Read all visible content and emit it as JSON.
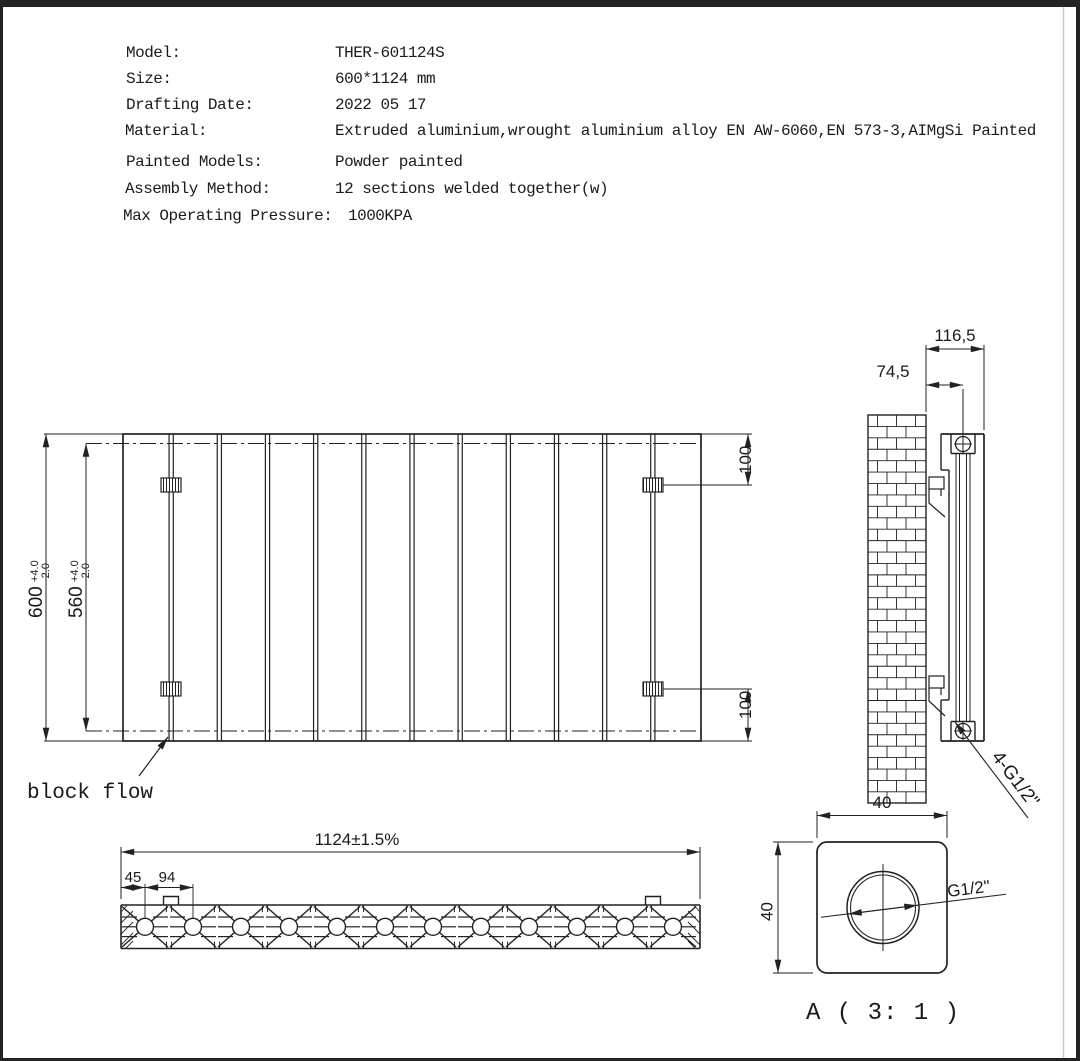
{
  "specs": [
    {
      "label": "Model:",
      "value": "THER-601124S"
    },
    {
      "label": "Size:",
      "value": "600*1124 mm"
    },
    {
      "label": "Drafting Date:",
      "value": "2022 05 17"
    },
    {
      "label": "Material:",
      "value": "Extruded aluminium,wrought aluminium alloy EN AW-6060,EN 573-3,AIMgSi Painted"
    },
    {
      "label": "Painted Models:",
      "value": "Powder painted"
    },
    {
      "label": "Assembly Method:",
      "value": "12 sections welded together(w)"
    },
    {
      "label": "Max Operating Pressure:",
      "value": "1000KPA"
    }
  ],
  "front_view": {
    "height": "600",
    "height_tol_up": "+4.0",
    "height_tol_dn": "-2.0",
    "inner_height": "560",
    "inner_tol_up": "+4.0",
    "inner_tol_dn": "-2.0",
    "top_offset": "100",
    "bottom_offset": "100",
    "flow_note": "block flow"
  },
  "side_view": {
    "total_depth": "116,5",
    "center_depth": "74,5",
    "connections": "4-G1/2\""
  },
  "bottom_view": {
    "total_width": "1124±1.5%",
    "end_offset": "45",
    "section_pitch": "94"
  },
  "detail_view": {
    "width": "40",
    "height": "40",
    "thread": "G1/2\"",
    "title": "A ( 3: 1 )"
  }
}
